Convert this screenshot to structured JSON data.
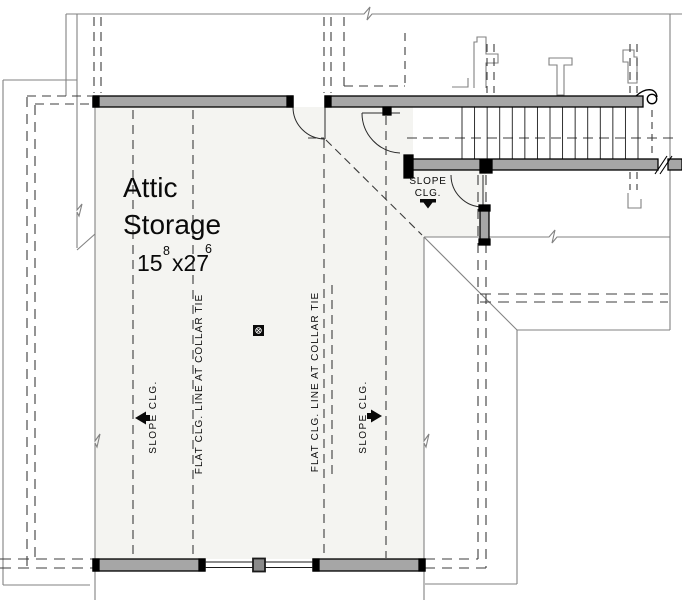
{
  "room": {
    "name_line1": "Attic",
    "name_line2": "Storage",
    "dim_feet_a": "15",
    "dim_sup_a": "8",
    "dim_feet_b": "x27",
    "dim_sup_b": "6"
  },
  "labels": {
    "stair_slope_line1": "SLOPE",
    "stair_slope_line2": "CLG.",
    "slope_left": "SLOPE CLG.",
    "slope_right": "SLOPE CLG.",
    "flat_left": "FLAT CLG. LINE AT COLLAR TIE",
    "flat_right": "FLAT CLG. LINE AT COLLAR TIE"
  },
  "stair": {
    "tread_count": 15
  },
  "colors": {
    "wall_fill": "#a6a6a6",
    "wall_edge": "#000000",
    "room_fill": "#f4f4f1",
    "thin_line": "#828282",
    "dash_line": "#3c3c3c",
    "marker": "#0a0a0a"
  }
}
